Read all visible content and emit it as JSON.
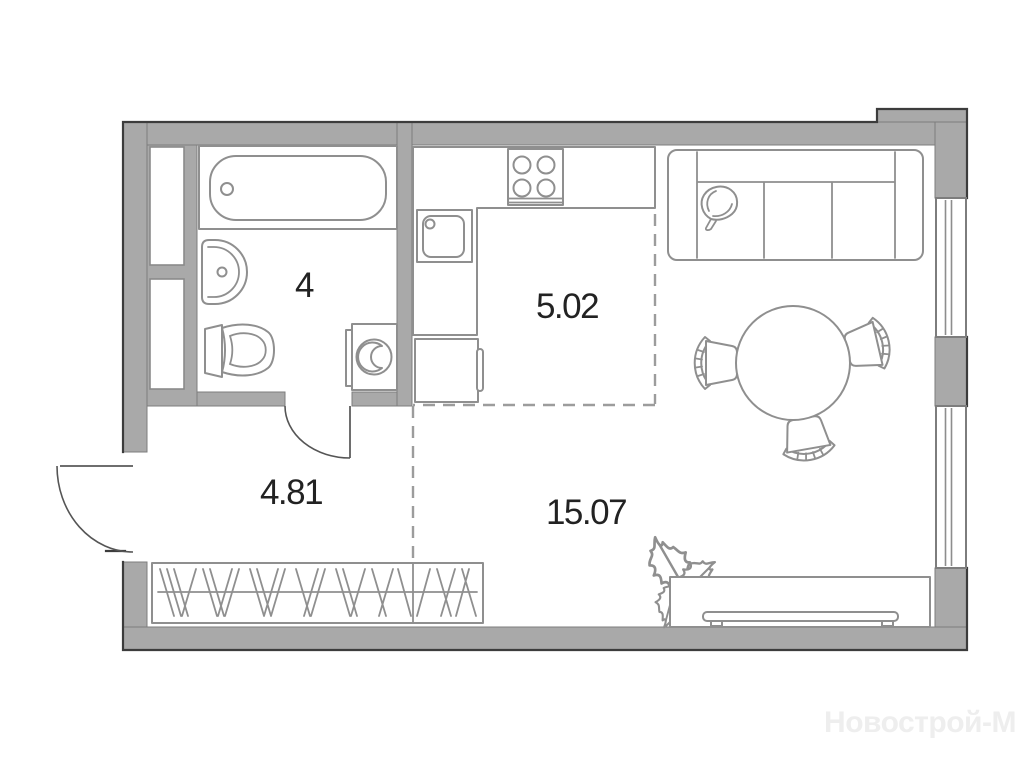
{
  "plan": {
    "title": "studio-apartment-floor-plan",
    "rooms": [
      {
        "name": "bathroom",
        "area_label": "4"
      },
      {
        "name": "kitchen",
        "area_label": "5.02"
      },
      {
        "name": "hallway",
        "area_label": "4.81"
      },
      {
        "name": "living-room",
        "area_label": "15.07"
      }
    ],
    "watermark": "Новострой-М",
    "colors": {
      "wall_fill": "#a9a9a9",
      "wall_outline": "#3c3c3c",
      "furniture_stroke": "#8f8f8f",
      "zone_dash": "#9c9c9c",
      "label_text": "#222222",
      "watermark_text": "#eeeeee",
      "background": "#ffffff"
    }
  }
}
